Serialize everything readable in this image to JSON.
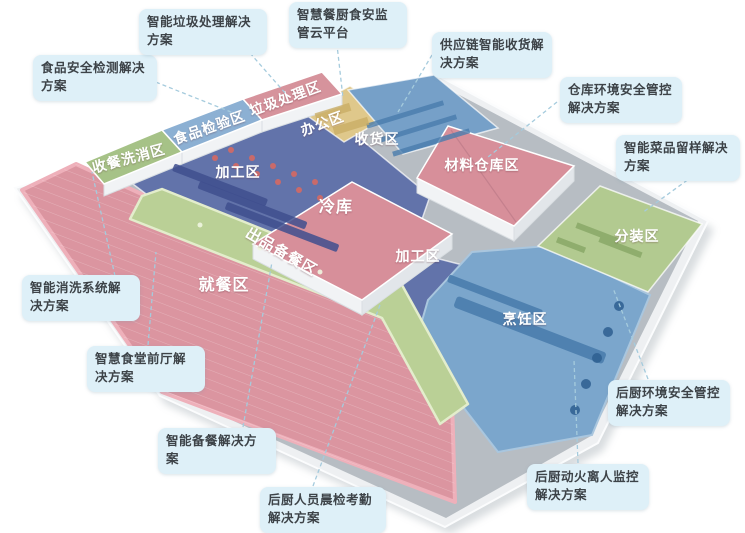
{
  "colors": {
    "background": "#ffffff",
    "callout_bg": "#def0f8",
    "callout_text": "#3d4348",
    "leader_line": "#a5cbdd",
    "slab": "#eef0f2",
    "slab_shadow": "#9aa4ac",
    "corridor": "#b7bdc3",
    "zone_dining": "#db95a0",
    "dining_border": "#eeb0ba",
    "zone_processing": "#6273aa",
    "zone_cooking": "#7ba6cc",
    "zone_receiving": "#76a0c8",
    "zone_office": "#dfc88b",
    "roof_warehouse": "#d78f9a",
    "roof_cold": "#d78f9a",
    "zone_packing": "#b2ca90",
    "zone_serving": "#bad096",
    "roof_washing": "#a6c287",
    "roof_inspection": "#8cb0d3",
    "roof_garbage": "#d6939c",
    "wall_face": "#f1f3f5",
    "zone_label_text": "#ffffff"
  },
  "zones": [
    {
      "id": "wash-return",
      "label": "收餐洗消区"
    },
    {
      "id": "food-inspection",
      "label": "食品检验区"
    },
    {
      "id": "garbage-processing",
      "label": "垃圾处理区"
    },
    {
      "id": "office",
      "label": "办公区"
    },
    {
      "id": "receiving",
      "label": "收货区"
    },
    {
      "id": "processing-left",
      "label": "加工区"
    },
    {
      "id": "cold-storage",
      "label": "冷库"
    },
    {
      "id": "material-warehouse",
      "label": "材料仓库区"
    },
    {
      "id": "processing-right",
      "label": "加工区"
    },
    {
      "id": "serving-prep",
      "label": "出品备餐区"
    },
    {
      "id": "dining",
      "label": "就餐区"
    },
    {
      "id": "cooking",
      "label": "烹饪区"
    },
    {
      "id": "packing",
      "label": "分装区"
    }
  ],
  "callouts": [
    {
      "id": "food-safety-testing",
      "label": "食品安全检测解决方案"
    },
    {
      "id": "smart-garbage",
      "label": "智能垃圾处理解决方案"
    },
    {
      "id": "smart-kitchen-cloud",
      "label": "智慧餐厨食安监管云平台"
    },
    {
      "id": "supply-chain-receiving",
      "label": "供应链智能收货解决方案"
    },
    {
      "id": "warehouse-env-safety",
      "label": "仓库环境安全管控解决方案"
    },
    {
      "id": "smart-dish-sample",
      "label": "智能菜品留样解决方案"
    },
    {
      "id": "kitchen-env-safety",
      "label": "后厨环境安全管控解决方案"
    },
    {
      "id": "kitchen-fire-monitor",
      "label": "后厨动火离人监控解决方案"
    },
    {
      "id": "staff-morning-check",
      "label": "后厨人员晨检考勤解决方案"
    },
    {
      "id": "smart-meal-prep",
      "label": "智能备餐解决方案"
    },
    {
      "id": "dining-front-hall",
      "label": "智慧食堂前厅解决方案"
    },
    {
      "id": "smart-washing-system",
      "label": "智能消洗系统解决方案"
    }
  ]
}
